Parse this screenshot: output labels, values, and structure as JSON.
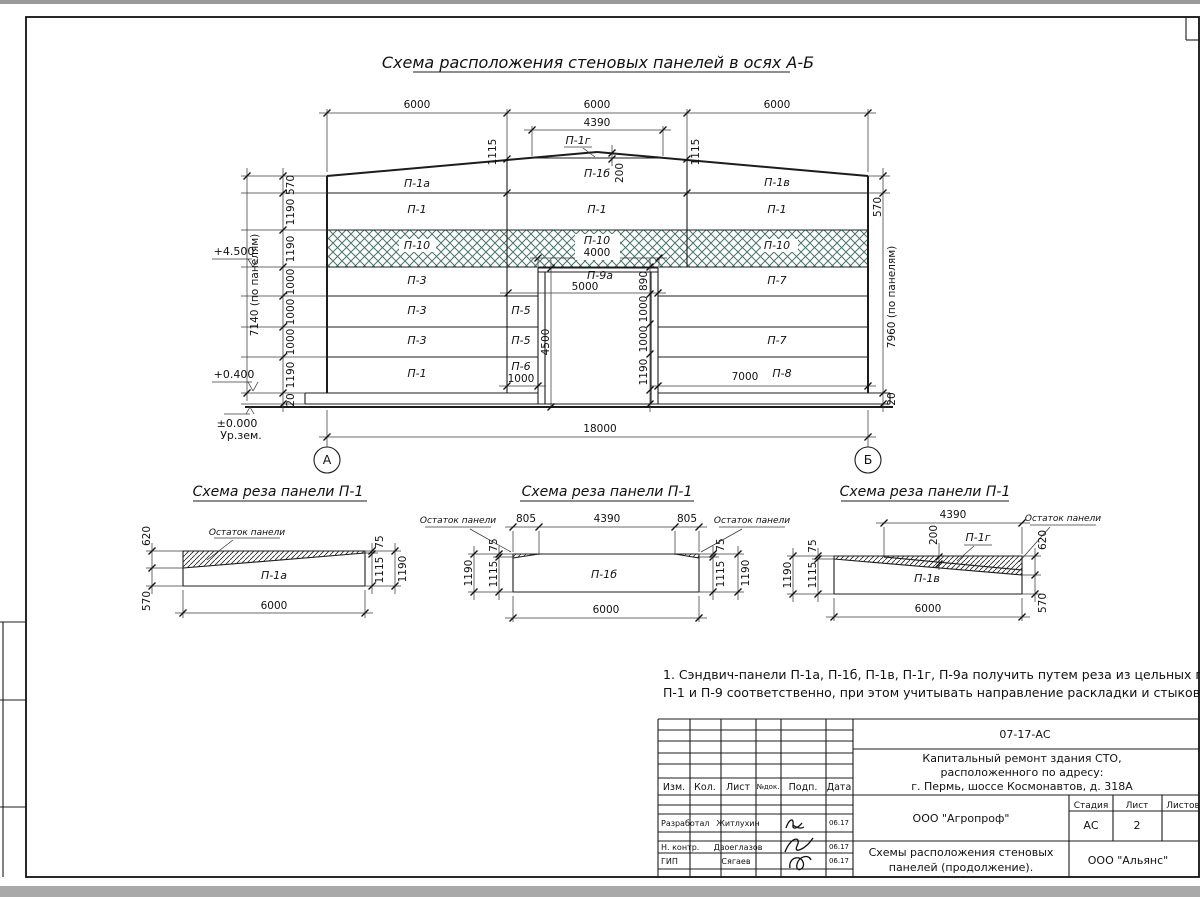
{
  "page": {
    "main_title": "Схема расположения стеновых панелей в осях А-Б",
    "note_line1": "1. Сэндвич-панели П-1а, П-1б, П-1в, П-1г, П-9а получить путем реза из цельных панелей",
    "note_line2": "П-1 и П-9 соответственно, при этом учитывать направление раскладки и стыкового шва."
  },
  "elevation": {
    "axes": {
      "a": "А",
      "b": "Б"
    },
    "marks": {
      "lvl_4500": "+4.500",
      "lvl_0400": "+0.400",
      "lvl_0000": "±0.000",
      "ground": "Ур.зем."
    },
    "panels": {
      "p1a": "П-1а",
      "p1b": "П-1б",
      "p1v": "П-1в",
      "p1g": "П-1г",
      "p1": "П-1",
      "p3": "П-3",
      "p5": "П-5",
      "p6": "П-6",
      "p7": "П-7",
      "p8": "П-8",
      "p9a": "П-9а",
      "p10": "П-10"
    },
    "dims": {
      "span": [
        "6000",
        "6000",
        "6000"
      ],
      "d4390": "4390",
      "d1115": "1115",
      "d200": "200",
      "left_chain": [
        "570",
        "1190",
        "1190",
        "1000",
        "1000",
        "1000",
        "1190",
        "20"
      ],
      "left_total": "7140 (по панелям)",
      "right_570": "570",
      "right_total": "7960 (по панелям)",
      "right_20": "20",
      "d4000": "4000",
      "d5000": "5000",
      "d4500": "4500",
      "door_chain": [
        "890",
        "1000",
        "1000",
        "1190"
      ],
      "d1000": "1000",
      "d7000": "7000",
      "d18000": "18000"
    }
  },
  "schemes": [
    {
      "title": "Схема реза панели П-1",
      "panel": "П-1а",
      "remnant": "Остаток панели",
      "d620": "620",
      "d570": "570",
      "d75": "75",
      "d1115": "1115",
      "d1190": "1190",
      "d6000": "6000"
    },
    {
      "title": "Схема реза панели П-1",
      "panel": "П-1б",
      "remnant_l": "Остаток панели",
      "remnant_r": "Остаток панели",
      "d805_l": "805",
      "d4390": "4390",
      "d805_r": "805",
      "d75": "75",
      "d1115": "1115",
      "d1190": "1190",
      "d6000": "6000"
    },
    {
      "title": "Схема реза панели П-1",
      "panel": "П-1в",
      "piece": "П-1г",
      "remnant": "Остаток панели",
      "d4390": "4390",
      "d200": "200",
      "d620": "620",
      "d570": "570",
      "d75": "75",
      "d1115": "1115",
      "d1190": "1190",
      "d6000": "6000"
    }
  ],
  "titleblock": {
    "code": "07-17-АС",
    "project_line1": "Капитальный ремонт здания СТО,",
    "project_line2": "расположенного по адресу:",
    "project_line3": "г. Пермь, шоссе Космонавтов, д. 318А",
    "columns": {
      "izm": "Изм.",
      "kol": "Кол.",
      "list": "Лист",
      "ndok": "№док.",
      "podp": "Подп.",
      "data": "Дата"
    },
    "rows": [
      {
        "role": "Разработал",
        "name": "Житлухин",
        "date": "06.17"
      },
      {
        "role": "Н. контр.",
        "name": "Двоеглазов",
        "date": "06.17"
      },
      {
        "role": "ГИП",
        "name": "Сягаев",
        "date": "06.17"
      }
    ],
    "org": "ООО \"Агропроф\"",
    "stage_label": "Стадия",
    "sheet_label": "Лист",
    "sheets_label": "Листов",
    "stage": "АС",
    "sheet_num": "2",
    "doc_title_line1": "Схемы расположения стеновых",
    "doc_title_line2": "панелей (продолжение).",
    "firm": "ООО \"Альянс\""
  },
  "colors": {
    "hatch_green": "#48756a",
    "line": "#1c1c1c",
    "paper": "#ffffff"
  }
}
